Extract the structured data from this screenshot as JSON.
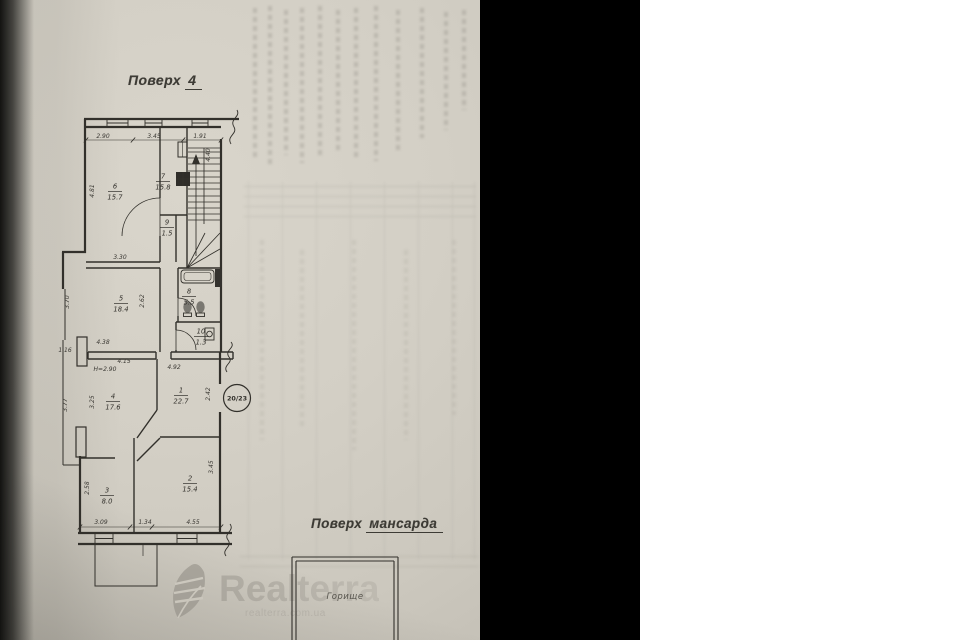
{
  "photo": {
    "floor4": {
      "title": {
        "label": "Поверх",
        "value": "4"
      },
      "entry_circle": "20/23",
      "rooms": [
        {
          "num": "6",
          "area": "15.7",
          "x": 115,
          "y": 191
        },
        {
          "num": "7",
          "area": "15.8",
          "x": 163,
          "y": 181
        },
        {
          "num": "9",
          "area": "1.5",
          "x": 167,
          "y": 227
        },
        {
          "num": "5",
          "area": "18.4",
          "x": 121,
          "y": 303
        },
        {
          "num": "8",
          "area": "5.5",
          "x": 189,
          "y": 296
        },
        {
          "num": "10",
          "area": "1.3",
          "x": 201,
          "y": 336
        },
        {
          "num": "4",
          "area": "17.6",
          "x": 113,
          "y": 401
        },
        {
          "num": "1",
          "area": "22.7",
          "x": 181,
          "y": 395
        },
        {
          "num": "2",
          "area": "15.4",
          "x": 190,
          "y": 483
        },
        {
          "num": "3",
          "area": "8.0",
          "x": 107,
          "y": 495
        }
      ],
      "dims": [
        {
          "t": "2.90",
          "x": 103,
          "y": 138
        },
        {
          "t": "3.45",
          "x": 154,
          "y": 138
        },
        {
          "t": "1.91",
          "x": 200,
          "y": 138
        },
        {
          "t": "4.40",
          "x": 210,
          "y": 155,
          "r": 1
        },
        {
          "t": "4.81",
          "x": 94,
          "y": 191,
          "r": 1
        },
        {
          "t": "3.30",
          "x": 120,
          "y": 259
        },
        {
          "t": "2.62",
          "x": 144,
          "y": 301,
          "r": 1
        },
        {
          "t": "3.70",
          "x": 69,
          "y": 302,
          "r": 1
        },
        {
          "t": "1.16",
          "x": 65,
          "y": 352
        },
        {
          "t": "4.38",
          "x": 103,
          "y": 344
        },
        {
          "t": "4.15",
          "x": 124,
          "y": 363
        },
        {
          "t": "H=2.90",
          "x": 105,
          "y": 371
        },
        {
          "t": "4.92",
          "x": 174,
          "y": 369
        },
        {
          "t": "3.25",
          "x": 94,
          "y": 402,
          "r": 1
        },
        {
          "t": "3.77",
          "x": 67,
          "y": 405,
          "r": 1
        },
        {
          "t": "2.42",
          "x": 210,
          "y": 394,
          "r": 1
        },
        {
          "t": "3.45",
          "x": 213,
          "y": 467,
          "r": 1
        },
        {
          "t": "2.58",
          "x": 89,
          "y": 488,
          "r": 1
        },
        {
          "t": "3.09",
          "x": 101,
          "y": 524
        },
        {
          "t": "1.34",
          "x": 145,
          "y": 524
        },
        {
          "t": "4.55",
          "x": 193,
          "y": 524
        }
      ]
    },
    "attic": {
      "title": {
        "label": "Поверх",
        "value": "мансарда"
      },
      "room_label": "Горище"
    },
    "watermark": {
      "brand": "Realterra",
      "domain": "realterra.com.ua",
      "logo_icon": "leaf-logo"
    },
    "colors": {
      "paper": "#d3cfc5",
      "ink": "#32302b",
      "band": "#000000",
      "watermark": "#96928a"
    }
  }
}
